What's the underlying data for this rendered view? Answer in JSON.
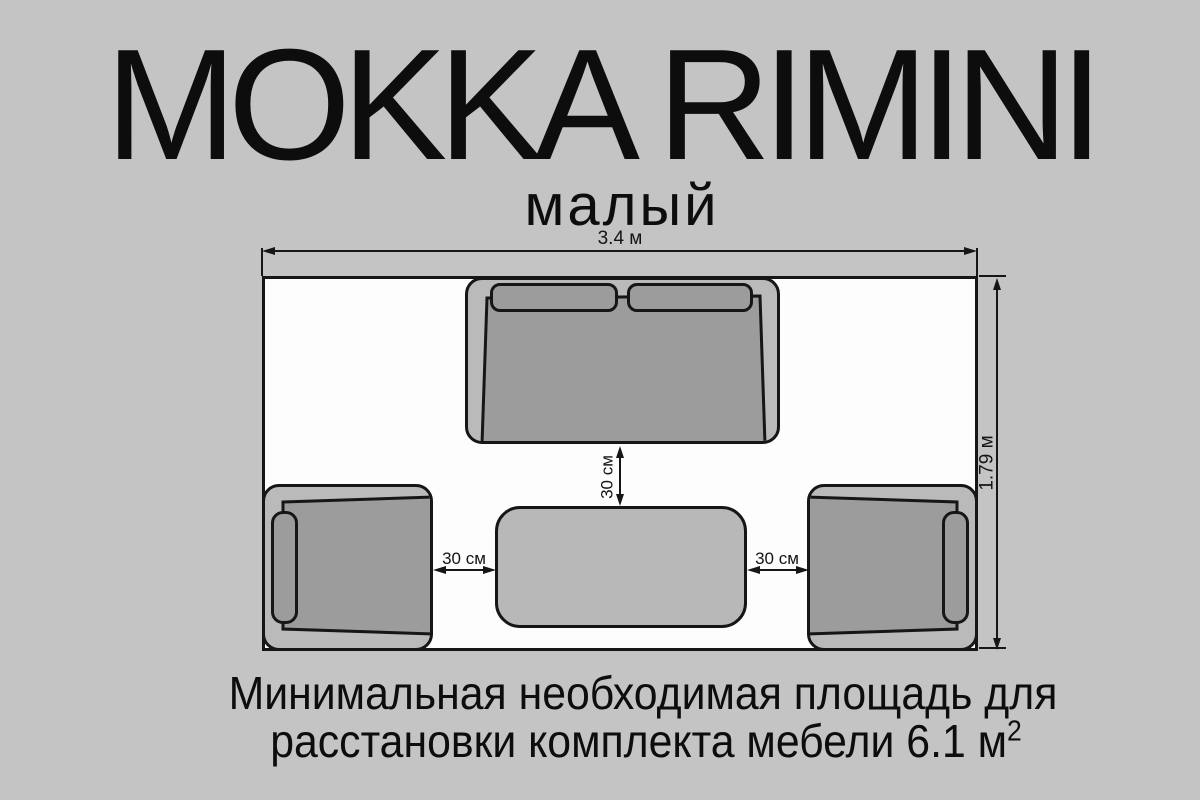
{
  "header": {
    "title": "MOKKA RIMINI",
    "subtitle": "малый"
  },
  "plan": {
    "room_width_label": "3.4 м",
    "room_depth_label": "1.79 м",
    "sofa_to_table_gap_label": "30 см",
    "left_chair_to_table_gap_label": "30 см",
    "right_chair_to_table_gap_label": "30 см",
    "furniture": [
      "sofa",
      "armchair-left",
      "armchair-right",
      "coffee-table"
    ]
  },
  "caption": {
    "line1": "Минимальная необходимая площадь для",
    "line2_text": "расстановки комплекта мебели 6.1 м",
    "line2_superscript": "2"
  },
  "colors": {
    "background": "#c4c4c4",
    "room_fill": "#fdfdfd",
    "furniture_body": "#bababa",
    "furniture_seat": "#9c9c9c",
    "table_fill": "#b8b8b8",
    "line": "#161616"
  }
}
